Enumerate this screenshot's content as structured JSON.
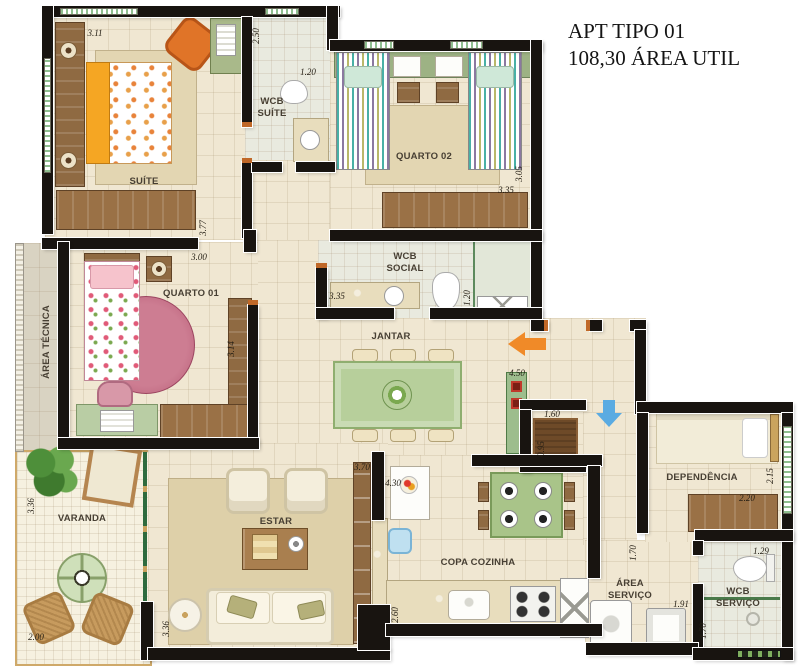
{
  "title": {
    "line1": "APT TIPO 01",
    "line2": "108,30 ÁREA UTIL"
  },
  "rooms": {
    "suite": "SUÍTE",
    "wcb_suite": "WCB\nSUÍTE",
    "quarto02": "QUARTO 02",
    "wcb_social": "WCB\nSOCIAL",
    "area_tecnica": "ÁREA TÉCNICA",
    "quarto01": "QUARTO 01",
    "jantar": "JANTAR",
    "varanda": "VARANDA",
    "estar": "ESTAR",
    "copa": "COPA COZINHA",
    "dependencia": "DEPENDÊNCIA",
    "area_servico": "ÁREA\nSERVIÇO",
    "wcb_servico": "WCB\nSERVIÇO"
  },
  "dims": [
    "3.11",
    "2.50",
    "1.20",
    "3.05",
    "3.35",
    "3.77",
    "3.00",
    "3.35",
    "1.20",
    "3.14",
    "3.70",
    "4.50",
    "1.60",
    "0.95",
    "2.15",
    "2.20",
    "1.70",
    "1.91",
    "1.29",
    "1.70",
    "3.36",
    "2.00",
    "3.36",
    "4.30",
    "2.60"
  ],
  "colors": {
    "wall": "#181410",
    "floor": "#f0e7d2",
    "entry_arrow": "#f08a28",
    "service_arrow": "#5aabe2"
  }
}
